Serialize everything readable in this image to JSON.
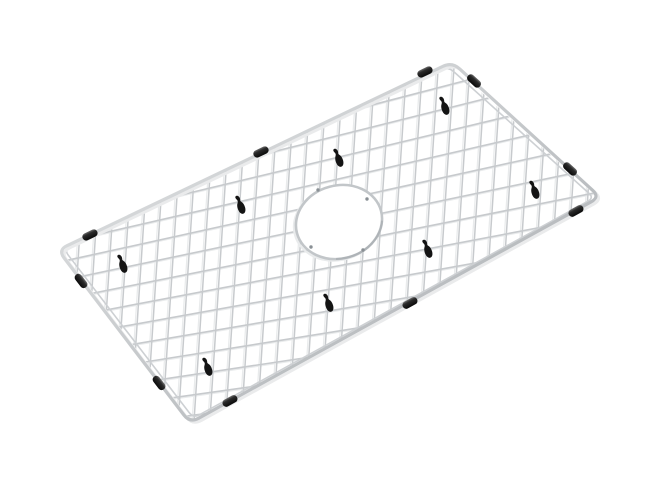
{
  "meta": {
    "description": "Product photo of a rectangular stainless steel wire sink bottom grid shown at an angle on a plain white background, with a round drain opening, ten black rubber edge bumpers clipped on the frame, and eight black rubber feet"
  },
  "canvas": {
    "width": 658,
    "height": 482,
    "background": "#ffffff"
  },
  "colors": {
    "wire": "#c7cacd",
    "wire_shadow": "#e9ebec",
    "rim": "#cdd0d3",
    "frame_light": "#e6e8e9",
    "frame_dark": "#a5a9ad",
    "frame_shadow": "#eaebec",
    "ring": "#c2c6c9",
    "ring_shade": "#aeb3b7",
    "ring_tick": "#8a9095",
    "bumper_light": "#6b6b6b",
    "bumper_dark": "#0a0a0a",
    "foot": "#141414"
  },
  "frame": {
    "corners": [
      [
        58,
        250
      ],
      [
        452,
        62
      ],
      [
        600,
        197
      ],
      [
        190,
        423
      ]
    ],
    "corner_trim": 10,
    "stroke_width": 3.2,
    "shadow_offset": [
      2.6,
      2.2
    ]
  },
  "rim": {
    "inset": 6,
    "corner_trim": 7,
    "stroke_width": 1.6
  },
  "clip_inset": 2.5,
  "dense_wires": {
    "count": 34,
    "x_start": 64,
    "x_step": 15.8,
    "ref_y": 233,
    "dx_per_dy": -0.065,
    "stroke_width": 1.5,
    "y_top": 38,
    "y_bottom": 446
  },
  "sparse_wires": {
    "count": 17,
    "y_start": 74,
    "y_step": 21.6,
    "ref_x": 325,
    "slope_start": -0.28,
    "slope_step": 0.01,
    "stroke_width": 1.6,
    "x_left": 30,
    "x_right": 628
  },
  "wire_shadow_offset": [
    -2.0,
    1.6
  ],
  "drain": {
    "cx": 339,
    "cy": 222,
    "rx": 43.5,
    "ry": 36.5,
    "rotate": -15,
    "ring_width": 2.6,
    "ticks": [
      [
        318,
        190
      ],
      [
        367,
        199
      ],
      [
        311,
        247
      ],
      [
        363,
        250
      ]
    ]
  },
  "bumpers": {
    "width": 16,
    "height": 7.5,
    "radius": 3.6,
    "items": [
      {
        "x": 90,
        "y": 235,
        "angle": -25.5
      },
      {
        "x": 261,
        "y": 152,
        "angle": -25.5
      },
      {
        "x": 425,
        "y": 72,
        "angle": -25.5
      },
      {
        "x": 230,
        "y": 401,
        "angle": -28.9
      },
      {
        "x": 410,
        "y": 303,
        "angle": -28.9
      },
      {
        "x": 576,
        "y": 211,
        "angle": -28.9
      },
      {
        "x": 81,
        "y": 281,
        "angle": 52.6
      },
      {
        "x": 159,
        "y": 383,
        "angle": 52.6
      },
      {
        "x": 474,
        "y": 81,
        "angle": 42.4
      },
      {
        "x": 570,
        "y": 169,
        "angle": 42.4
      }
    ]
  },
  "feet": {
    "rotate": -8,
    "positions": [
      [
        444,
        106
      ],
      [
        338,
        158
      ],
      [
        240,
        205
      ],
      [
        122,
        264
      ],
      [
        534,
        190
      ],
      [
        427,
        249
      ],
      [
        328,
        303
      ],
      [
        207,
        367
      ]
    ]
  }
}
